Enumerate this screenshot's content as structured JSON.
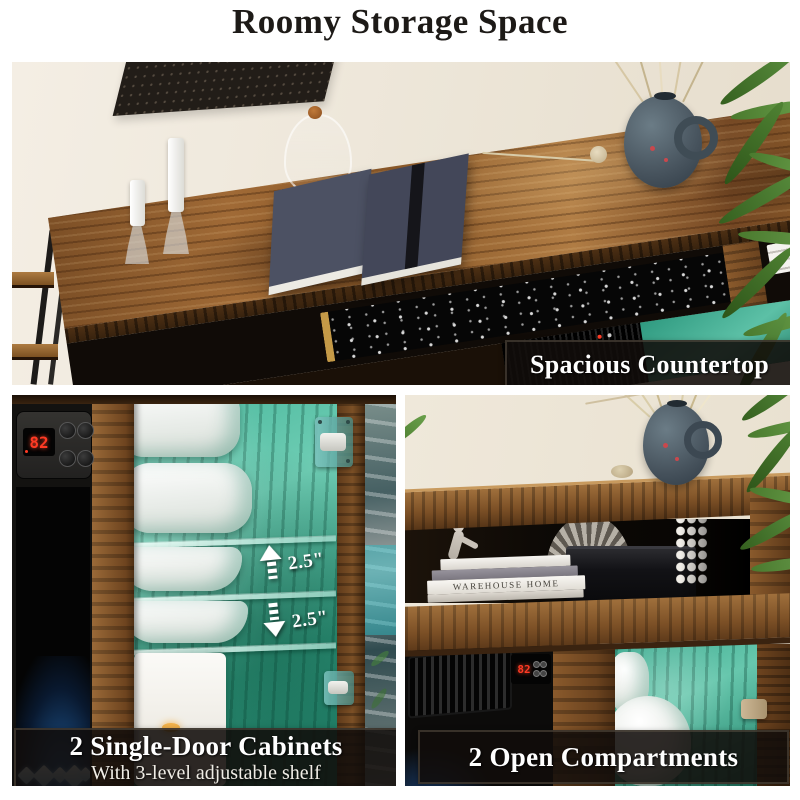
{
  "title": "Roomy Storage Space",
  "captions": {
    "top": "Spacious Countertop",
    "bottom_left": "2 Single-Door Cabinets",
    "bottom_left_sub": "With 3-level adjustable shelf",
    "bottom_right": "2 Open Compartments"
  },
  "annotations": {
    "shelf_gap_upper": "2.5\"",
    "shelf_gap_lower": "2.5\""
  },
  "displays": {
    "left_fireplace_temp": "82",
    "right_fireplace_temp": "82"
  },
  "decor": {
    "book_spine": "WAREHOUSE HOME"
  },
  "icons": {
    "shelf_gap_upper": "up-arrow-icon",
    "shelf_gap_lower": "down-arrow-icon"
  },
  "colors": {
    "led_teal": "#3fbf9f",
    "wood_brown": "#8a5a2e",
    "display_red": "#ff3a24",
    "banner_bg": "#14100c",
    "title_text": "#1d1a17",
    "caption_text": "#ffffff"
  }
}
